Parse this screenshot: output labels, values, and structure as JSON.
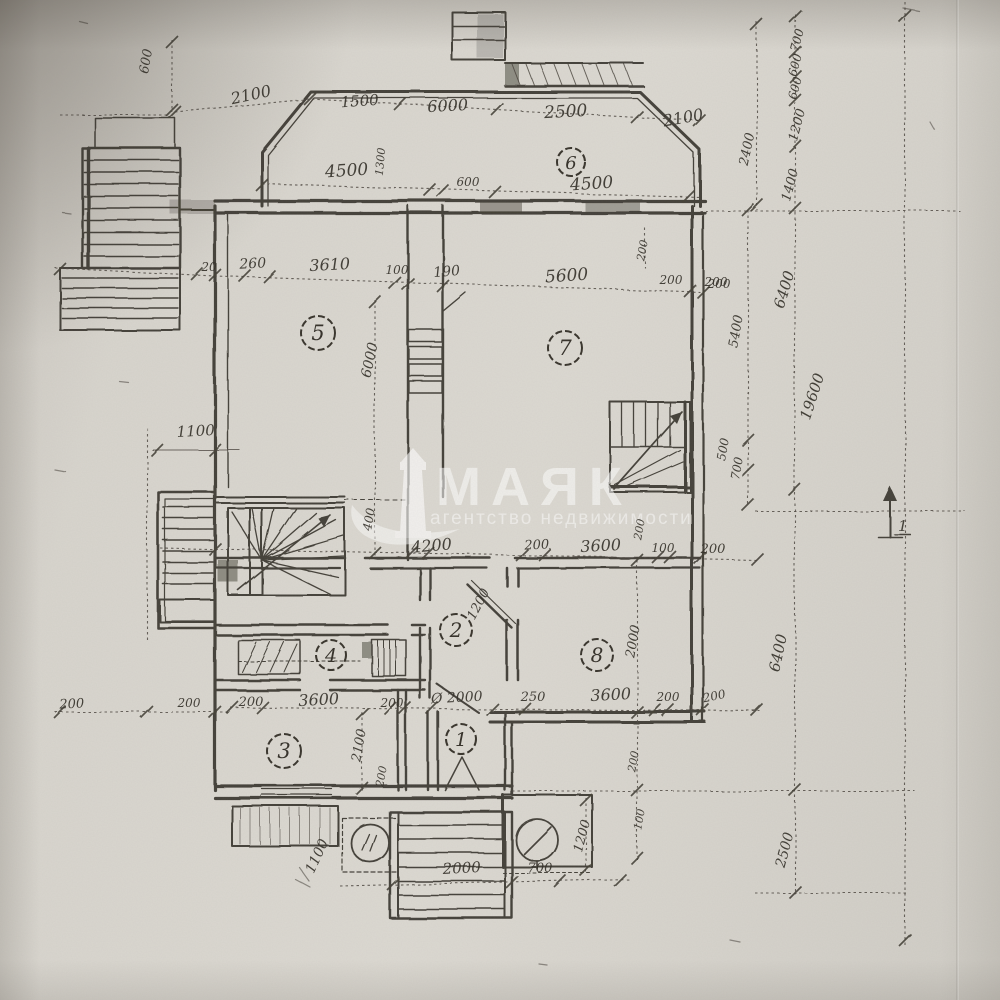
{
  "document": {
    "kind": "scanned architectural floor plan photo",
    "language": "Russian"
  },
  "palette": {
    "paper": "#d8d5ce",
    "ink": "#39352d",
    "watermark": "#ffffff"
  },
  "watermark": {
    "brand": "МАЯК",
    "tagline": "агентство недвижимости",
    "icon": "lighthouse-with-wave"
  },
  "north_marker": {
    "label": "1"
  },
  "rooms": [
    {
      "number": "1",
      "x": 461,
      "y": 739,
      "r": 15
    },
    {
      "number": "2",
      "x": 456,
      "y": 630,
      "r": 16
    },
    {
      "number": "3",
      "x": 284,
      "y": 751,
      "r": 17
    },
    {
      "number": "4",
      "x": 331,
      "y": 655,
      "r": 15
    },
    {
      "number": "5",
      "x": 318,
      "y": 333,
      "r": 17
    },
    {
      "number": "6",
      "x": 571,
      "y": 162,
      "r": 14
    },
    {
      "number": "7",
      "x": 565,
      "y": 348,
      "r": 17
    },
    {
      "number": "8",
      "x": 597,
      "y": 655,
      "r": 16
    }
  ],
  "dimension_labels": [
    {
      "text": "600",
      "x": 150,
      "y": 62,
      "rot": -80,
      "size": 13
    },
    {
      "text": "2100",
      "x": 252,
      "y": 100,
      "rot": -12,
      "size": 16
    },
    {
      "text": "1500",
      "x": 360,
      "y": 106,
      "rot": -4,
      "size": 15
    },
    {
      "text": "6000",
      "x": 448,
      "y": 111,
      "rot": -3,
      "size": 16
    },
    {
      "text": "2500",
      "x": 566,
      "y": 117,
      "rot": -3,
      "size": 17
    },
    {
      "text": "2100",
      "x": 684,
      "y": 123,
      "rot": -10,
      "size": 16
    },
    {
      "text": "4500",
      "x": 347,
      "y": 176,
      "rot": -4,
      "size": 17
    },
    {
      "text": "1300",
      "x": 384,
      "y": 162,
      "rot": -85,
      "size": 11
    },
    {
      "text": "600",
      "x": 468,
      "y": 186,
      "rot": 0,
      "size": 12
    },
    {
      "text": "4500",
      "x": 592,
      "y": 189,
      "rot": -4,
      "size": 17
    },
    {
      "text": "700",
      "x": 801,
      "y": 41,
      "rot": -75,
      "size": 12
    },
    {
      "text": "600",
      "x": 799,
      "y": 66,
      "rot": -75,
      "size": 12
    },
    {
      "text": "600",
      "x": 799,
      "y": 89,
      "rot": -75,
      "size": 12
    },
    {
      "text": "1200",
      "x": 801,
      "y": 126,
      "rot": -75,
      "size": 13
    },
    {
      "text": "1400",
      "x": 794,
      "y": 186,
      "rot": -75,
      "size": 13
    },
    {
      "text": "2400",
      "x": 751,
      "y": 150,
      "rot": -78,
      "size": 13
    },
    {
      "text": "200",
      "x": 716,
      "y": 286,
      "rot": 0,
      "size": 12
    },
    {
      "text": "5400",
      "x": 740,
      "y": 332,
      "rot": -80,
      "size": 13
    },
    {
      "text": "500",
      "x": 727,
      "y": 450,
      "rot": -80,
      "size": 12
    },
    {
      "text": "700",
      "x": 741,
      "y": 469,
      "rot": -80,
      "size": 12
    },
    {
      "text": "6400",
      "x": 789,
      "y": 291,
      "rot": -73,
      "size": 15
    },
    {
      "text": "19600",
      "x": 817,
      "y": 398,
      "rot": -72,
      "size": 15
    },
    {
      "text": "6400",
      "x": 783,
      "y": 654,
      "rot": -78,
      "size": 15
    },
    {
      "text": "2500",
      "x": 789,
      "y": 851,
      "rot": -75,
      "size": 14
    },
    {
      "text": "200",
      "x": 715,
      "y": 700,
      "rot": -12,
      "size": 12
    },
    {
      "text": "20",
      "x": 209,
      "y": 271,
      "rot": 0,
      "size": 12
    },
    {
      "text": "260",
      "x": 253,
      "y": 268,
      "rot": -3,
      "size": 14
    },
    {
      "text": "3610",
      "x": 330,
      "y": 270,
      "rot": -3,
      "size": 16
    },
    {
      "text": "100",
      "x": 397,
      "y": 274,
      "rot": 0,
      "size": 12
    },
    {
      "text": "190",
      "x": 447,
      "y": 276,
      "rot": -5,
      "size": 14
    },
    {
      "text": "5600",
      "x": 567,
      "y": 281,
      "rot": -4,
      "size": 17
    },
    {
      "text": "200",
      "x": 671,
      "y": 284,
      "rot": 0,
      "size": 12
    },
    {
      "text": "200",
      "x": 719,
      "y": 288,
      "rot": 0,
      "size": 12
    },
    {
      "text": "6000",
      "x": 374,
      "y": 361,
      "rot": -78,
      "size": 14
    },
    {
      "text": "1100",
      "x": 196,
      "y": 436,
      "rot": -3,
      "size": 15
    },
    {
      "text": "400",
      "x": 373,
      "y": 520,
      "rot": -80,
      "size": 12
    },
    {
      "text": "200",
      "x": 646,
      "y": 251,
      "rot": -80,
      "size": 11
    },
    {
      "text": "4200",
      "x": 432,
      "y": 551,
      "rot": -5,
      "size": 16
    },
    {
      "text": "200",
      "x": 537,
      "y": 549,
      "rot": -3,
      "size": 13
    },
    {
      "text": "3600",
      "x": 601,
      "y": 551,
      "rot": -3,
      "size": 16
    },
    {
      "text": "100",
      "x": 663,
      "y": 552,
      "rot": 0,
      "size": 12
    },
    {
      "text": "200",
      "x": 713,
      "y": 553,
      "rot": 0,
      "size": 13
    },
    {
      "text": "200",
      "x": 643,
      "y": 530,
      "rot": -80,
      "size": 11
    },
    {
      "text": "1200",
      "x": 482,
      "y": 606,
      "rot": -62,
      "size": 13
    },
    {
      "text": "2000",
      "x": 637,
      "y": 642,
      "rot": -80,
      "size": 13
    },
    {
      "text": "200",
      "x": 72,
      "y": 708,
      "rot": -3,
      "size": 13
    },
    {
      "text": "200",
      "x": 189,
      "y": 707,
      "rot": 0,
      "size": 12
    },
    {
      "text": "200",
      "x": 251,
      "y": 706,
      "rot": 0,
      "size": 13
    },
    {
      "text": "3600",
      "x": 319,
      "y": 705,
      "rot": -3,
      "size": 16
    },
    {
      "text": "200",
      "x": 392,
      "y": 707,
      "rot": 0,
      "size": 12
    },
    {
      "text": "Ø 2000",
      "x": 457,
      "y": 702,
      "rot": -3,
      "size": 14
    },
    {
      "text": "250",
      "x": 533,
      "y": 701,
      "rot": 0,
      "size": 13
    },
    {
      "text": "3600",
      "x": 611,
      "y": 700,
      "rot": -3,
      "size": 16
    },
    {
      "text": "200",
      "x": 668,
      "y": 701,
      "rot": 0,
      "size": 12
    },
    {
      "text": "2100",
      "x": 363,
      "y": 746,
      "rot": -80,
      "size": 13
    },
    {
      "text": "200",
      "x": 385,
      "y": 777,
      "rot": -80,
      "size": 11
    },
    {
      "text": "1100",
      "x": 321,
      "y": 858,
      "rot": -65,
      "size": 14
    },
    {
      "text": "2000",
      "x": 462,
      "y": 873,
      "rot": -3,
      "size": 15
    },
    {
      "text": "700",
      "x": 540,
      "y": 872,
      "rot": 0,
      "size": 13
    },
    {
      "text": "1200",
      "x": 586,
      "y": 837,
      "rot": -75,
      "size": 13
    },
    {
      "text": "200",
      "x": 637,
      "y": 762,
      "rot": -80,
      "size": 11
    },
    {
      "text": "100",
      "x": 643,
      "y": 820,
      "rot": -80,
      "size": 11
    }
  ]
}
